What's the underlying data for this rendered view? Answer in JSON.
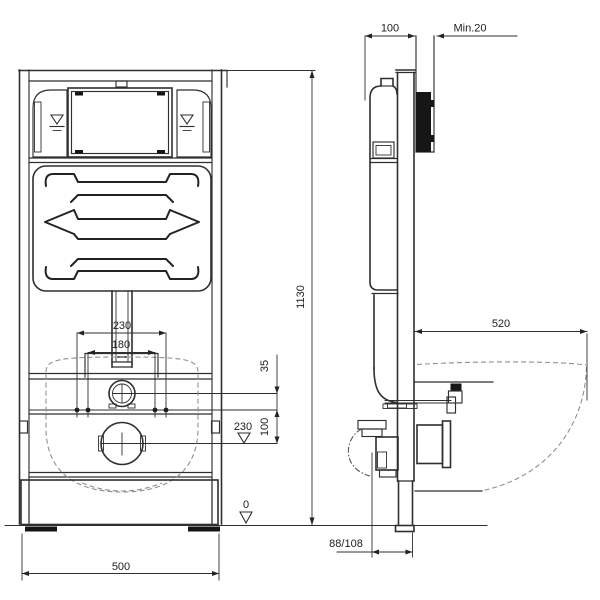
{
  "drawing": {
    "front": {
      "bolt_spacing_outer": "230",
      "bolt_spacing_inner": "180",
      "inlet_offset": "35",
      "outlet_offset": "100",
      "outlet_level": "230",
      "floor_level": "0",
      "frame_width": "500"
    },
    "side": {
      "frame_depth": "100",
      "wall_min": "Min.20",
      "frame_height": "1130",
      "bowl_length": "520",
      "outlet_wall_distance": "88/108"
    }
  }
}
